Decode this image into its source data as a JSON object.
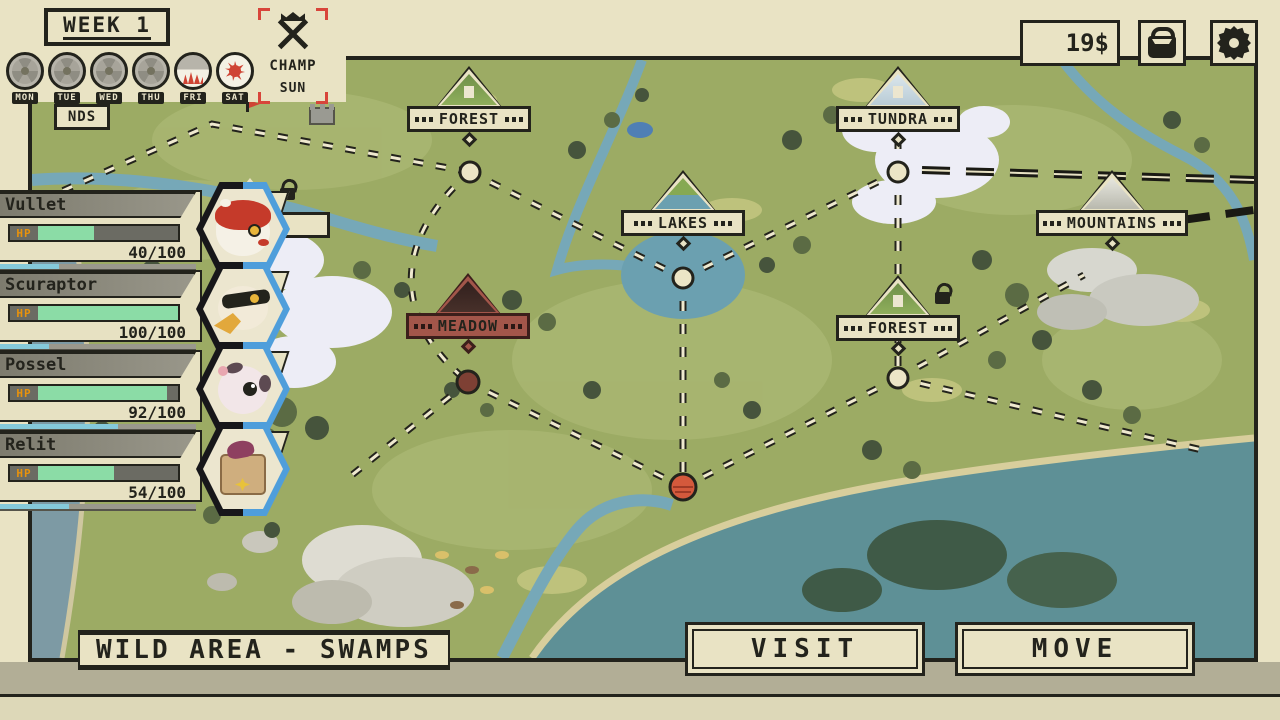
{
  "header": {
    "week_label": "WEEK 1",
    "days": [
      {
        "label": "MON",
        "state": "plain"
      },
      {
        "label": "TUE",
        "state": "plain"
      },
      {
        "label": "WED",
        "state": "plain"
      },
      {
        "label": "THU",
        "state": "plain"
      },
      {
        "label": "FRI",
        "state": "dawn"
      },
      {
        "label": "SAT",
        "state": "sun"
      }
    ],
    "champ": {
      "label": "CHAMP",
      "day_label": "SUN"
    }
  },
  "hud": {
    "money": "19$"
  },
  "party": {
    "members": [
      {
        "name": "Vullet",
        "level": "9",
        "hp_label": "HP",
        "hp_current": 40,
        "hp_max": 100,
        "hp_text": "40/100",
        "xp_percent": 30,
        "species_icon": "red-ferret-portrait"
      },
      {
        "name": "Scuraptor",
        "level": "10",
        "hp_label": "HP",
        "hp_current": 100,
        "hp_max": 100,
        "hp_text": "100/100",
        "xp_percent": 25,
        "species_icon": "raptor-bird-portrait"
      },
      {
        "name": "Possel",
        "level": "7",
        "hp_label": "HP",
        "hp_current": 92,
        "hp_max": 100,
        "hp_text": "92/100",
        "xp_percent": 60,
        "species_icon": "possum-portrait"
      },
      {
        "name": "Relit",
        "level": "8",
        "hp_label": "HP",
        "hp_current": 54,
        "hp_max": 100,
        "hp_text": "54/100",
        "xp_percent": 35,
        "species_icon": "bag-creature-portrait"
      }
    ]
  },
  "map": {
    "locations": [
      {
        "name": "FOREST",
        "variant": "forest"
      },
      {
        "name": "TUNDRA",
        "variant": "tundra"
      },
      {
        "name": "LAKES",
        "variant": "lakes"
      },
      {
        "name": "MOUNTAINS",
        "variant": "mountains"
      },
      {
        "name": "MEADOW",
        "variant": "meadow-selected"
      },
      {
        "name": "FOREST",
        "variant": "forest"
      }
    ],
    "partial_west_label": "NDS",
    "selected_area_label": "WILD AREA - SWAMPS"
  },
  "actions": {
    "visit_label": "VISIT",
    "move_label": "MOVE"
  },
  "colors": {
    "ui_cream": "#e9e3c4",
    "outline": "#23231c",
    "accent_red": "#d8453a",
    "meadow_red": "#a3564a",
    "hp_green": "#8bdca6",
    "hp_label_orange": "#e8920c",
    "xp_blue": "#85c9da",
    "water_teal": "#5e9096",
    "land_green": "#9cab64"
  }
}
